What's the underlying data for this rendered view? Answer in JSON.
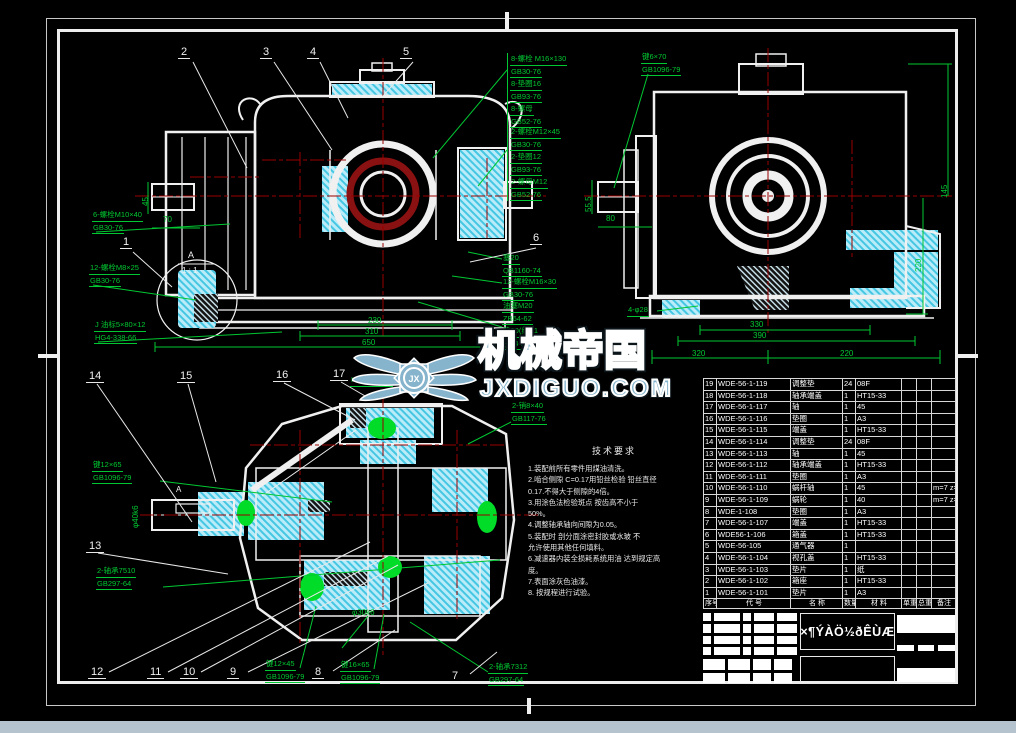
{
  "watermark": {
    "brand": "机械帝国",
    "site": "JXDIGUO.COM",
    "monogram": "JX"
  },
  "balloons": {
    "b1": "1",
    "b2": "2",
    "b3": "3",
    "b4": "4",
    "b5": "5",
    "b6": "6",
    "b7": "7",
    "b8": "8",
    "b9": "9",
    "b10": "10",
    "b11": "11",
    "b12": "12",
    "b13": "13",
    "b14": "14",
    "b15": "15",
    "b16": "16",
    "b17": "17"
  },
  "detail": {
    "letter": "A",
    "scale": "1 : 1",
    "section_marker": "A"
  },
  "callouts": {
    "bolt_m10": [
      "6-螺栓M10×40",
      "GB30-76"
    ],
    "bolt_m8": [
      "12-螺栓M8×25",
      "GB30-76"
    ],
    "oil_gauge": [
      "J 油标5×80×12",
      "HG4-338-66"
    ],
    "bolt_m16_stack": [
      "8-螺栓 M16×130",
      "GB30-76",
      "8-垫圈16",
      "GB93-76",
      "8-螺母",
      "GB52-76"
    ],
    "bolt_m12_stack": [
      "2-螺栓M12×45",
      "GB30-76",
      "2-垫圈12",
      "GB93-76",
      "2-螺母M12",
      "GB52-76"
    ],
    "key_6x70": [
      "键6×70",
      "GB1096-79"
    ],
    "plug_20": [
      "塞20",
      "QB1160-74"
    ],
    "bolt_m16x30": [
      "12-螺栓M16×30",
      "GB30-76"
    ],
    "oil_plug": [
      "油塞M20",
      "ZB64-62",
      "垫20(纸)-1",
      "HG4-338-66"
    ],
    "key_12x65": [
      "键12×65",
      "GB1096-79"
    ],
    "bearing_7510": [
      "2-轴承7510",
      "GB297-64"
    ],
    "pin_8x40": [
      "2-销8×40",
      "GB117-76"
    ],
    "key_12x45": [
      "键12×45",
      "GB1096-79"
    ],
    "key_16x65": [
      "键16×65",
      "GB1096-79"
    ],
    "bearing_7312": [
      "2-轴承7312",
      "GB297-64"
    ],
    "holes_28": "4-φ28",
    "hg_mark": "HG4-338-66"
  },
  "dims": {
    "front": {
      "d70": "70",
      "d45": "45",
      "d230": "230",
      "d310": "310",
      "d650": "650"
    },
    "side": {
      "d555": "55.5",
      "d80": "80",
      "d330": "330",
      "d390": "390",
      "d320": "320",
      "d220b": "220",
      "d145": "145",
      "d220r": "220"
    },
    "bottom": {
      "phi40": "φ40k6",
      "phi30": "φ30k6"
    }
  },
  "tech": {
    "title": "技术要求",
    "lines": [
      "1.装配前所有零件用煤油清洗。",
      "2.啮合侧隙 C=0.17用铅丝检验 铅丝直径",
      "0.17.不得大于侧隙的4倍。",
      "3.用涂色法检验斑点 按齿高不小于",
      "50%。",
      "4.调整轴承轴向间隙为0.05。",
      "5.装配时 剖分面涂密封胶或水玻 不",
      "允许使用其他任何填料。",
      "6.减速器内装全损耗系统用油 达到规定高",
      "度。",
      "7.表面涂灰色油漆。",
      "8.   按规程进行试验。"
    ]
  },
  "parts_table": {
    "headers": [
      "序号",
      "代 号",
      "名 称",
      "数量",
      "材 料",
      "单重",
      "总重",
      "备注"
    ],
    "rows": [
      [
        "19",
        "WDE-56-1-119",
        "调整垫",
        "24",
        "08F",
        "",
        "",
        ""
      ],
      [
        "18",
        "WDE-56-1-118",
        "轴承端盖",
        "1",
        "HT15-33",
        "",
        "",
        ""
      ],
      [
        "17",
        "WDE-56-1-117",
        "轴",
        "1",
        "45",
        "",
        "",
        ""
      ],
      [
        "16",
        "WDE-56-1-116",
        "垫圈",
        "1",
        "A3",
        "",
        "",
        ""
      ],
      [
        "15",
        "WDE-56-1-115",
        "端盖",
        "1",
        "HT15-33",
        "",
        "",
        ""
      ],
      [
        "14",
        "WDE-56-1-114",
        "调整垫",
        "24",
        "08F",
        "",
        "",
        ""
      ],
      [
        "13",
        "WDE-56-1-113",
        "轴",
        "1",
        "45",
        "",
        "",
        ""
      ],
      [
        "12",
        "WDE-56-1-112",
        "轴承端盖",
        "1",
        "HT15-33",
        "",
        "",
        ""
      ],
      [
        "11",
        "WDE-56-1-111",
        "垫圈",
        "1",
        "A3",
        "",
        "",
        ""
      ],
      [
        "10",
        "WDE-56-1-110",
        "蜗杆轴",
        "1",
        "45",
        "",
        "",
        "m=7 z=2"
      ],
      [
        "9",
        "WDE-56-1-109",
        "蜗轮",
        "1",
        "40",
        "",
        "",
        "m=7 z=31"
      ],
      [
        "8",
        "WDE-1-108",
        "垫圈",
        "1",
        "A3",
        "",
        "",
        ""
      ],
      [
        "7",
        "WDE-56-1-107",
        "端盖",
        "1",
        "HT15-33",
        "",
        "",
        ""
      ],
      [
        "6",
        "WDE56-1-106",
        "箱盖",
        "1",
        "HT15-33",
        "",
        "",
        ""
      ],
      [
        "5",
        "WDE-56-105",
        "通气器",
        "1",
        "",
        "",
        "",
        ""
      ],
      [
        "4",
        "WDE-56-1-104",
        "视孔盖",
        "1",
        "HT15-33",
        "",
        "",
        ""
      ],
      [
        "3",
        "WDE-56-1-103",
        "垫片",
        "1",
        "纸",
        "",
        "",
        ""
      ],
      [
        "2",
        "WDE-56-1-102",
        "箱座",
        "1",
        "HT15-33",
        "",
        "",
        ""
      ],
      [
        "1",
        "WDE-56-1-101",
        "垫片",
        "1",
        "A3",
        "",
        "",
        ""
      ]
    ]
  },
  "title_block": {
    "drawing_title": "×¶ÝÀÖ½ðÊÙÆ"
  }
}
